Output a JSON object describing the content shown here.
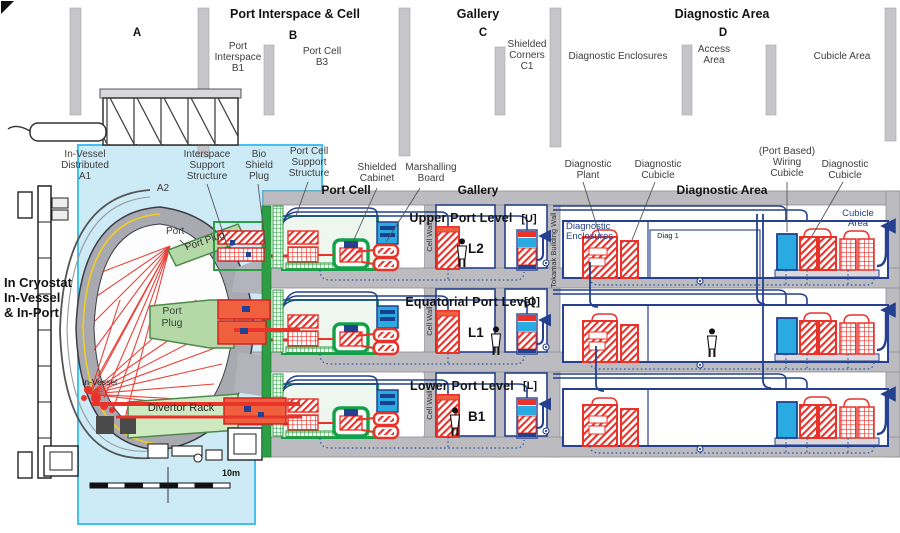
{
  "header": {
    "zones": {
      "port_interspace_cell": "Port Interspace & Cell",
      "gallery": "Gallery",
      "diagnostic_area": "Diagnostic Area"
    },
    "columns": {
      "a": "A",
      "b": "B",
      "c": "C",
      "d": "D"
    },
    "sublabels": {
      "port_interspace_b1": "Port\nInterspace\nB1",
      "port_cell_b3": "Port Cell\nB3",
      "shielded_corners_c1": "Shielded\nCorners\nC1",
      "diagnostic_enclosures": "Diagnostic Enclosures",
      "access_area": "Access\nArea",
      "cubicle_area": "Cubicle Area"
    }
  },
  "callouts": {
    "in_vessel_distributed_a1": "In-Vessel\nDistributed\nA1",
    "a2": "A2",
    "interspace_support_structure": "Interspace\nSupport\nStructure",
    "bio_shield_plug": "Bio\nShield\nPlug",
    "port_cell_support_structure": "Port Cell\nSupport\nStructure",
    "shielded_cabinet": "Shielded\nCabinet",
    "marshalling_board": "Marshalling\nBoard",
    "diagnostic_plant": "Diagnostic\nPlant",
    "diagnostic_cubicle_left": "Diagnostic\nCubicle",
    "port_based_wiring_cubicle": "(Port Based)\nWiring\nCubicle",
    "diagnostic_cubicle_right": "Diagnostic\nCubicle"
  },
  "sections": {
    "port_cell": "Port Cell",
    "gallery": "Gallery",
    "diagnostic_area": "Diagnostic Area"
  },
  "walls": {
    "cell_wall": "Cell Wall",
    "tokamak_building_wall": "Tokamak Building Wall"
  },
  "tokamak": {
    "in_cryostat": "In Cryostat\nIn-Vessel\n& In-Port",
    "port": "Port",
    "port_plug_upper": "Port Plug",
    "port_plug_equatorial": "Port\nPlug",
    "in_vessel": "In-Vessel",
    "divertor_rack": "Divertor Rack",
    "scale": "10m"
  },
  "rows": [
    {
      "title": "Upper Port Level",
      "code": "L2",
      "corner_code": "[U]",
      "diag_label": "Diagnostic\nEnclosures",
      "diag1": "Diag 1",
      "cubicle_area": "Cubicle\nArea"
    },
    {
      "title": "Equatorial Port Level",
      "code": "L1",
      "corner_code": "[Q]"
    },
    {
      "title": "Lower Port Level",
      "code": "B1",
      "corner_code": "[L]"
    }
  ],
  "colors": {
    "red": "#e8332a",
    "orange_red": "#f0603f",
    "cable_blue": "#24408e",
    "cabinet_blue": "#29abe2",
    "green": "#12a04b",
    "wall_gray": "#bcbcc0",
    "cyan_bg": "#cdeaf7"
  }
}
